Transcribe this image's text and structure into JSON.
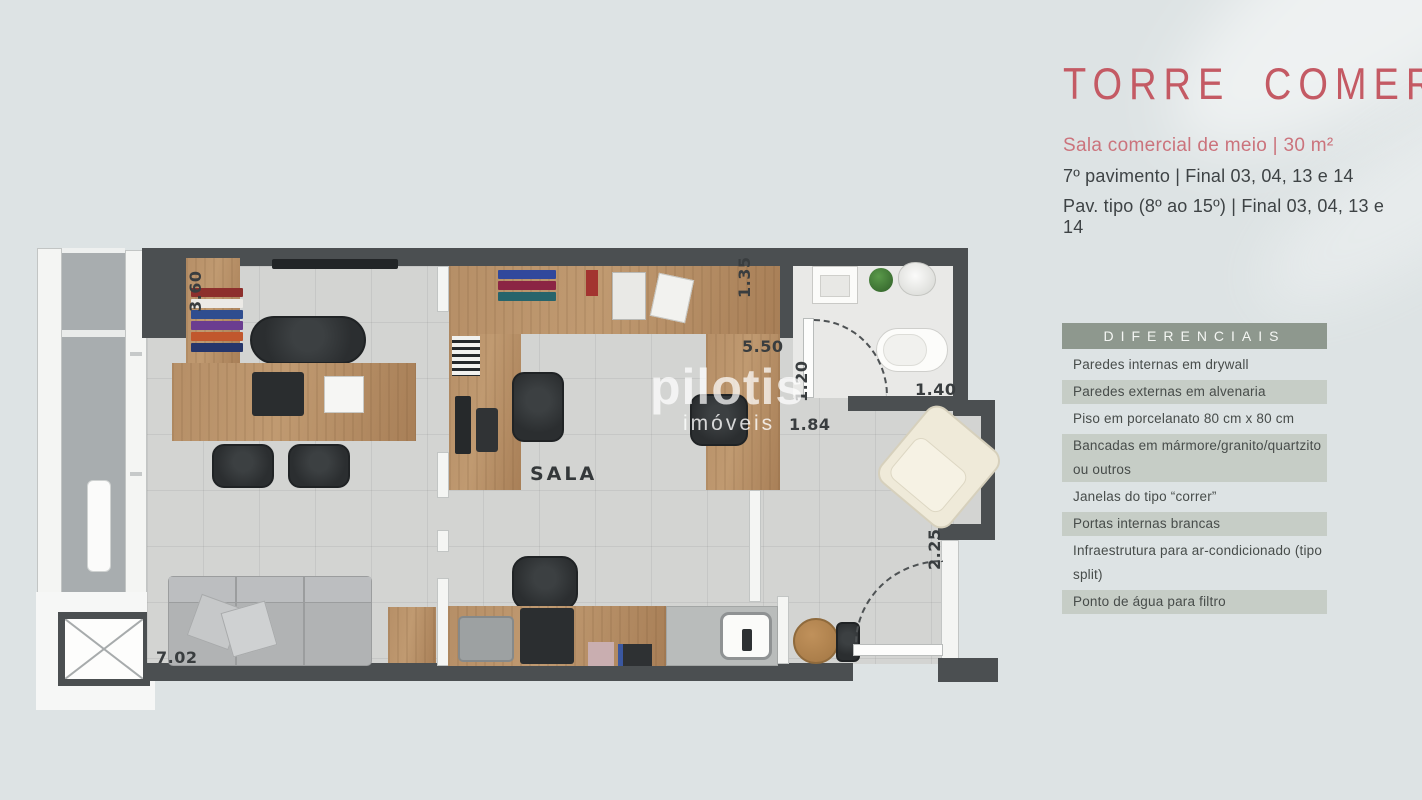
{
  "header": {
    "title": "TORRE COMERCIAL",
    "subtitle": "Sala comercial de meio | 30 m²",
    "line1": "7º pavimento | Final 03, 04, 13 e 14",
    "line2": "Pav. tipo (8º ao 15º) | Final 03, 04, 13 e 14"
  },
  "features": {
    "heading": "DIFERENCIAIS",
    "items": [
      "Paredes internas em drywall",
      "Paredes externas em alvenaria",
      "Piso em porcelanato 80 cm x 80 cm",
      "Bancadas em mármore/granito/quartzito ou outros",
      "Janelas do tipo “correr”",
      "Portas internas brancas",
      "Infraestrutura para ar-condicionado (tipo split)",
      "Ponto de água para filtro"
    ]
  },
  "floorplan": {
    "room_label": "SALA",
    "dimensions": {
      "left_wall": "3.60",
      "top_right": "1.35",
      "sala_width": "5.50",
      "bath_door": "1.20",
      "bath_width": "1.40",
      "hall_width": "1.84",
      "entry_wall": "2.25",
      "unit_width": "7.02"
    },
    "watermark": {
      "brand": "pilotis",
      "sub": "imóveis"
    }
  },
  "colors": {
    "bg": "#dde3e4",
    "accent_pink": "#c45a64",
    "subtitle_pink": "#cb737c",
    "text_dark": "#3e4345",
    "sage": "#8e988e",
    "stripe": "#c6cdc6",
    "wall": "#4b4f51",
    "wood": "#b18a62",
    "floor": "#d3d4d2",
    "corridor": "#a8adaf",
    "bath_floor": "#e9e9e7"
  }
}
